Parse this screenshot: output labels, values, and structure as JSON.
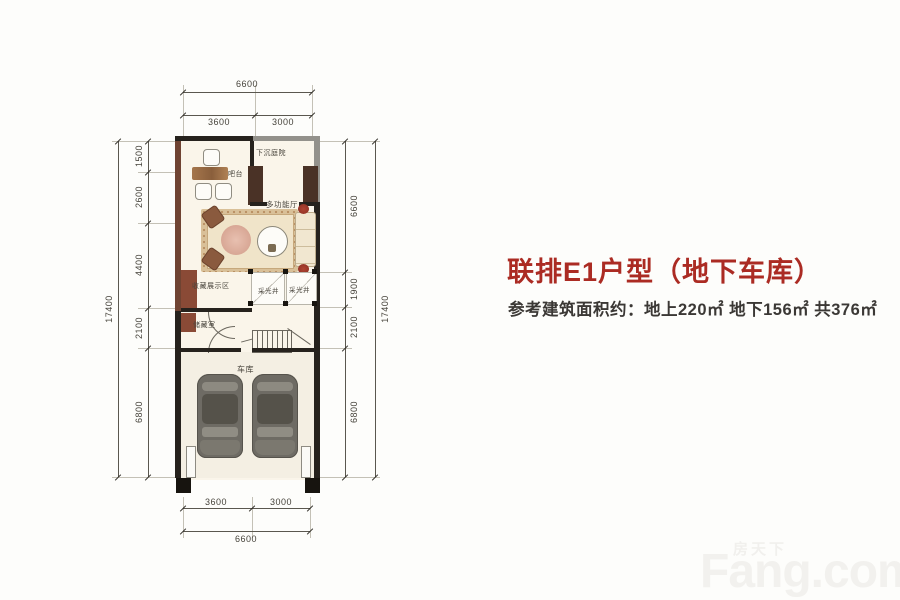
{
  "page": {
    "background": "#fdfdfb"
  },
  "header": {
    "title": "联排E1户型（地下车库）",
    "title_color": "#ab2b23",
    "subtitle": "参考建筑面积约：地上220㎡ 地下156㎡ 共376㎡"
  },
  "floorplan": {
    "rooms": {
      "courtyard": "下沉庭院",
      "bar": "吧台",
      "hall": "多功能厅",
      "display": "收藏展示区",
      "lightwell_a": "采光井",
      "lightwell_b": "采光井",
      "storage": "储藏室",
      "garage": "车库"
    },
    "dims": {
      "top_total": "6600",
      "top_seg1": "3600",
      "top_seg2": "3000",
      "bottom_seg1": "3600",
      "bottom_seg2": "3000",
      "bottom_total": "6600",
      "left_total": "17400",
      "left_seg1": "1500",
      "left_seg2": "2600",
      "left_seg3": "4400",
      "left_seg4": "2100",
      "left_seg5": "6800",
      "right_seg1": "6600",
      "right_seg2": "1900",
      "right_seg3": "2100",
      "right_seg4": "6800",
      "right_total": "17400"
    },
    "colors": {
      "wall": "#26221d",
      "wood_wall": "#6f4332",
      "floor": "#faf5ea",
      "accent_red": "#a23a2c"
    }
  },
  "watermark": {
    "brand_cn": "房天下",
    "brand_en": "Fang.com"
  }
}
